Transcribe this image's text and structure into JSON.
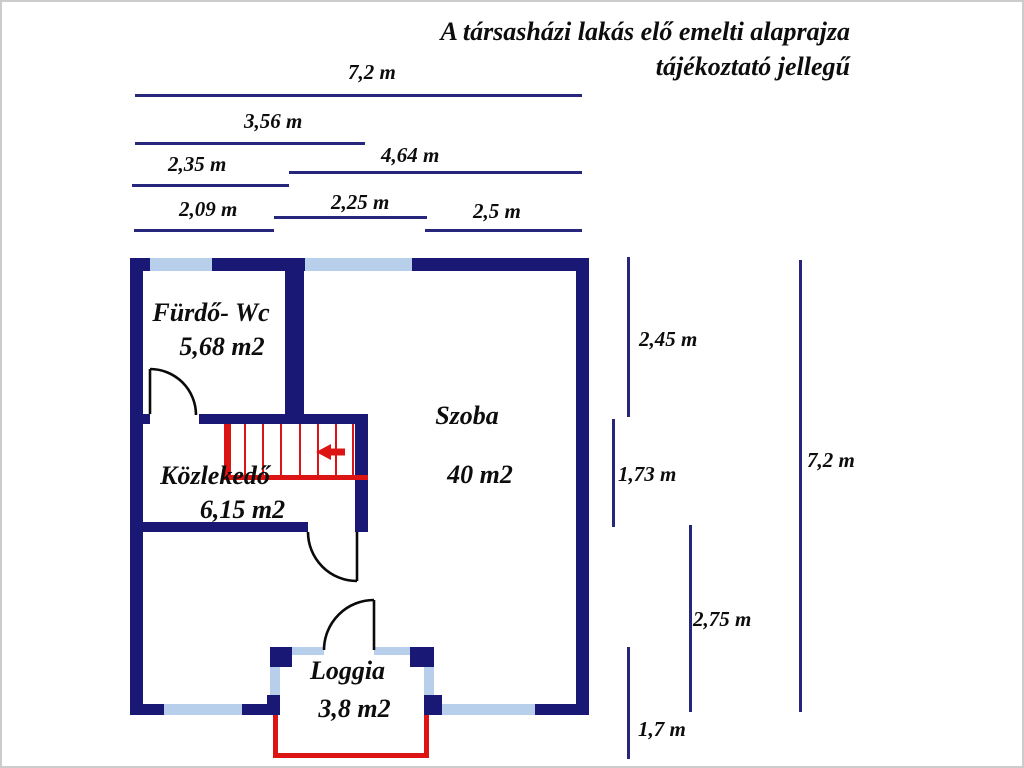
{
  "title": {
    "line1": "A társasházi lakás elő emelti alaprajza",
    "line2": "tájékoztató jellegű"
  },
  "rooms": {
    "furdo": {
      "name": "Fürdő- Wc",
      "area": "5,68 m2"
    },
    "szoba": {
      "name": "Szoba",
      "area": "40 m2"
    },
    "kozlekedo": {
      "name": "Közlekedő",
      "area": "6,15 m2"
    },
    "loggia": {
      "name": "Loggia",
      "area": "3,8 m2"
    }
  },
  "dims": {
    "top": {
      "total": "7,2 m",
      "d356": "3,56 m",
      "d235": "2,35 m",
      "d464": "4,64 m",
      "d209": "2,09 m",
      "d225": "2,25 m",
      "d25": "2,5 m"
    },
    "right": {
      "d245": "2,45 m",
      "d173": "1,73 m",
      "total": "7,2 m",
      "d275": "2,75 m",
      "d17": "1,7 m"
    }
  },
  "colors": {
    "wall": "#191975",
    "window": "#b7cfea",
    "stairs_red": "#dd1414",
    "dimension_line": "#26267d",
    "text": "#0d0d0d"
  }
}
